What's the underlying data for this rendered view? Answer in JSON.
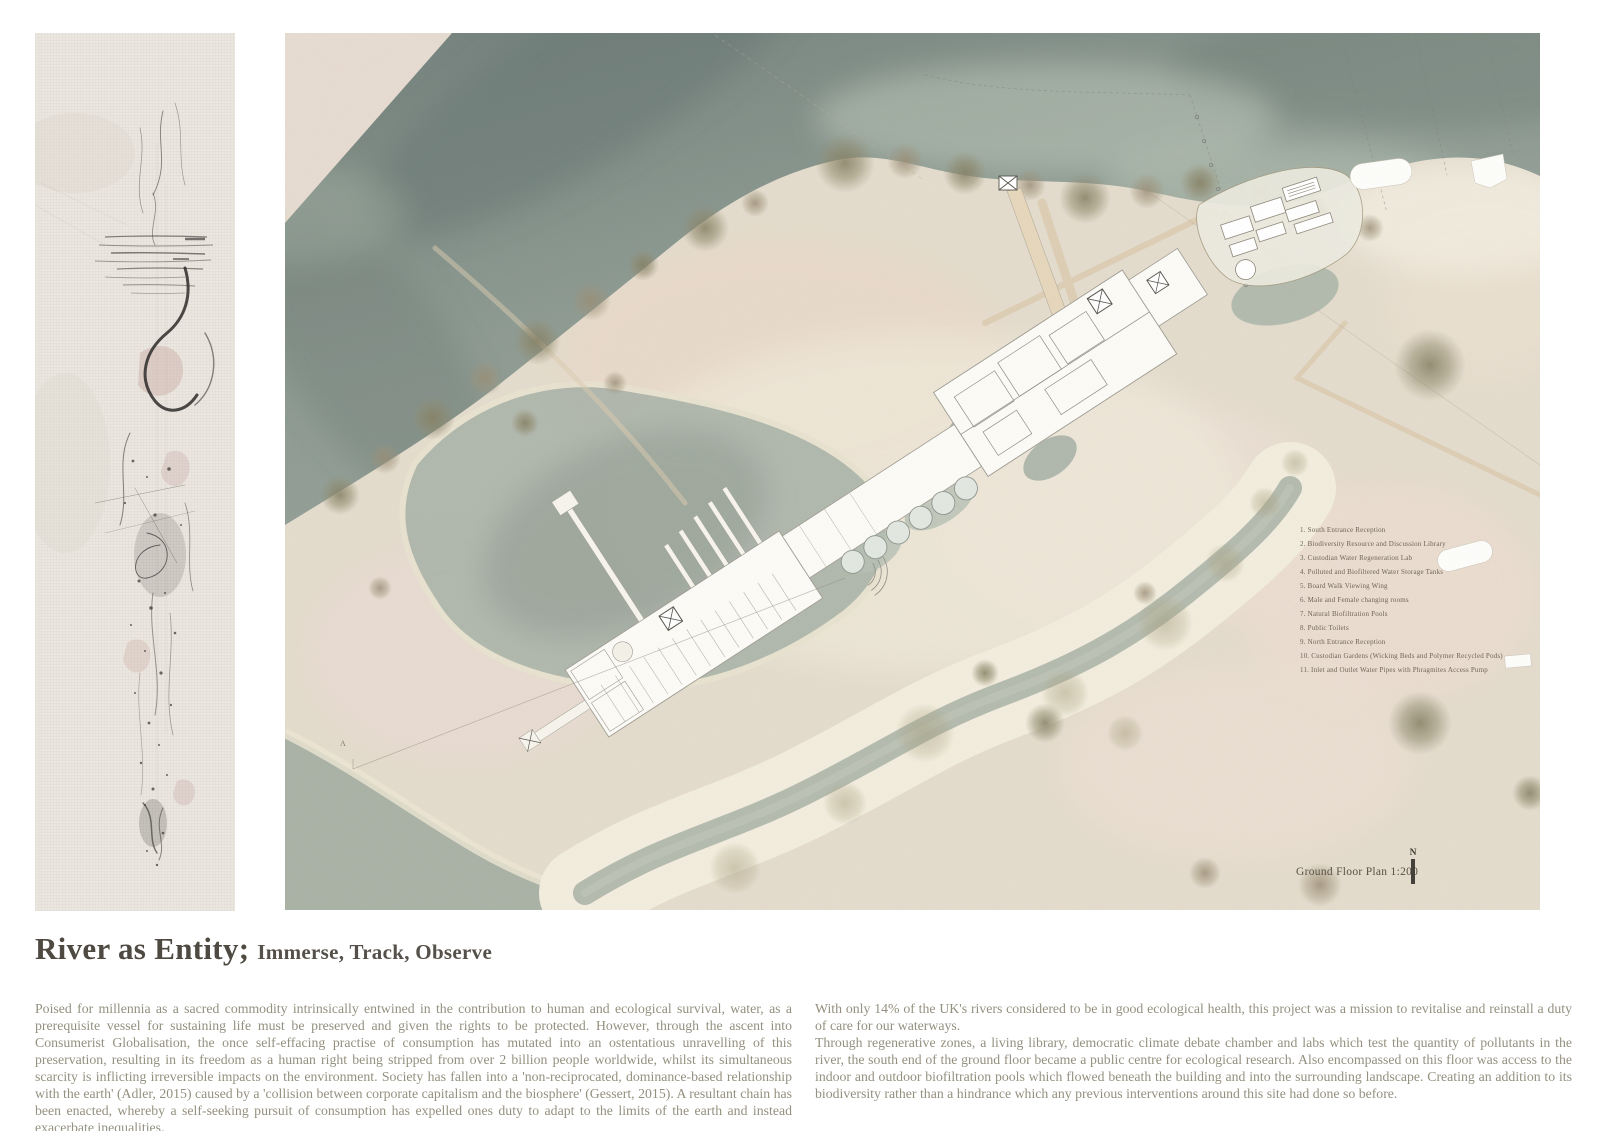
{
  "title": {
    "main": "River as Entity;",
    "subtitle": "Immerse, Track, Observe"
  },
  "body": {
    "left_paragraph": "Poised for millennia as a sacred commodity intrinsically entwined in the contribution to human and ecological survival, water, as a prerequisite vessel for sustaining life must be preserved and given the rights to be protected. However, through the ascent into Consumerist Globalisation, the once self-effacing practise of consumption has mutated into an ostentatious unravelling of this preservation, resulting in its freedom as a human right being stripped from over 2 billion people worldwide, whilst its simultaneous scarcity is inflicting irreversible impacts on the environment. Society has fallen into a 'non-reciprocated, dominance-based relationship with the earth' (Adler, 2015) caused by a 'collision between corporate capitalism and the biosphere' (Gessert, 2015). A resultant chain has been enacted, whereby a self-seeking pursuit of consumption has expelled ones duty to adapt to the limits of the earth and instead exacerbate inequalities.",
    "right_paragraph_1": "With only 14% of the UK's rivers considered to be in good ecological health, this project was a mission to revitalise and reinstall a duty of care for our waterways.",
    "right_paragraph_2": "Through regenerative zones, a living library, democratic climate debate chamber and labs which test the quantity of pollutants in the river, the south end of the ground floor became a public centre for ecological research. Also encompassed on this floor was access to the indoor and outdoor biofiltration pools which flowed beneath the building and into the surrounding landscape. Creating an addition to its biodiversity rather than a hindrance which any previous interventions around this site had done so before."
  },
  "plan": {
    "label": "Ground Floor Plan 1:200",
    "north_label": "N",
    "section_marker": "A",
    "legend_items": [
      "1. South Entrance Reception",
      "2. Biodiversity Resource and Discussion Library",
      "3. Custodian Water Regeneration Lab",
      "4. Polluted and Biofiltered Water Storage Tanks",
      "5. Board Walk Viewing Wing",
      "6. Male and Female changing rooms",
      "7. Natural Biofiltration Pools",
      "8. Public Toilets",
      "9. North Entrance Reception",
      "10. Custodian Gardens (Wicking Beds and Polymer Recycled Pods)",
      "11. Inlet and Outlet Water Pipes with Phragmites Access Pump"
    ],
    "colors": {
      "river": "#7d8a84",
      "terrain": "#e4dccd",
      "sand": "#f2edde",
      "pond": "#a9b3a7",
      "vegetation": "#8f8a6f",
      "building": "#fcfbf7",
      "body_text": "#94907f",
      "title_text": "#4e4a42"
    }
  }
}
